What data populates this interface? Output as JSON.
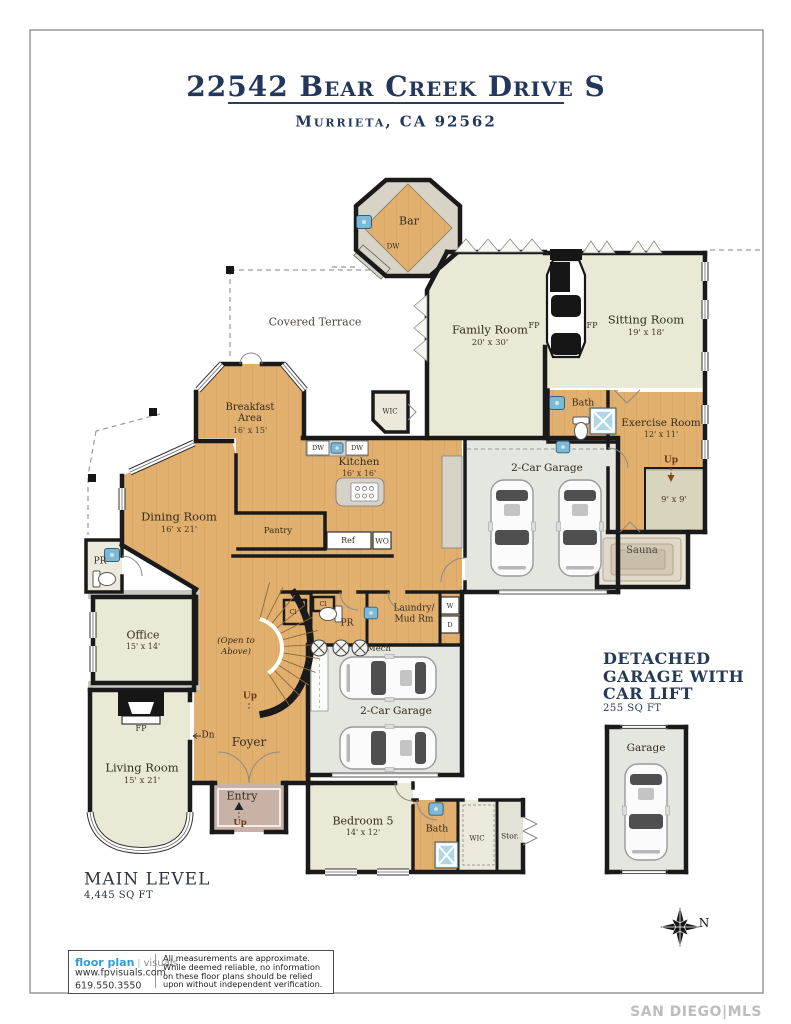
{
  "header": {
    "title": "22542 Bear Creek Drive S",
    "subtitle": "Murrieta, CA 92562"
  },
  "labels": {
    "bar": "Bar",
    "dw": "DW",
    "family_room": "Family Room",
    "family_room_dims": "20' x 30'",
    "sitting_room": "Sitting Room",
    "sitting_room_dims": "19' x 18'",
    "fp": "FP",
    "covered_terrace": "Covered Terrace",
    "wic": "WIC",
    "bath": "Bath",
    "exercise_room": "Exercise Room",
    "exercise_room_dims": "12' x 11'",
    "up": "Up",
    "dn": "Dn",
    "nine_by_nine": "9' x 9'",
    "sauna": "Sauna",
    "two_car_garage": "2-Car Garage",
    "breakfast_line1": "Breakfast",
    "breakfast_line2": "Area",
    "breakfast_dims": "16' x 15'",
    "kitchen": "Kitchen",
    "kitchen_dims": "16' x 16'",
    "pantry": "Pantry",
    "ref": "Ref",
    "wo": "WO",
    "dining_room": "Dining Room",
    "dining_room_dims": "16' x 21'",
    "pr": "PR",
    "office": "Office",
    "office_dims": "15' x 14'",
    "open_above_line1": "(Open to",
    "open_above_line2": "Above)",
    "cl": "Cl",
    "laundry_line1": "Laundry/",
    "laundry_line2": "Mud Rm",
    "washer": "W",
    "dryer": "D",
    "mech": "Mech",
    "foyer": "Foyer",
    "living_room": "Living Room",
    "living_room_dims": "15' x 21'",
    "entry": "Entry",
    "bedroom5": "Bedroom 5",
    "bedroom5_dims": "14' x 12'",
    "stor": "Stor.",
    "garage": "Garage"
  },
  "notes": {
    "main_level": "MAIN LEVEL",
    "main_level_area": "4,445 SQ FT",
    "detached_line1": "DETACHED",
    "detached_line2": "GARAGE WITH",
    "detached_line3": "CAR LIFT",
    "detached_area": "255 SQ FT",
    "north": "N"
  },
  "footer": {
    "brand_bold": "floor plan",
    "brand_light": "visuals",
    "website": "www.fpvisuals.com",
    "phone": "619.550.3550",
    "disclaimer": [
      "All measurements are approximate.",
      "While deemed reliable, no information",
      "on these floor plans should be relied",
      "upon without independent verification."
    ]
  },
  "watermark": "SAN DIEGO|MLS",
  "colors": {
    "accent_navy": "#23375c",
    "brand_blue": "#2f9ed6",
    "wood_floor": "#e2b06e",
    "cream_floor": "#e9e9d6",
    "garage_gray": "#e4e6e0",
    "fixture_blue": "#7db8d4",
    "wall_black": "#1a1a1a",
    "watermark_gray": "#bdbdbd"
  }
}
